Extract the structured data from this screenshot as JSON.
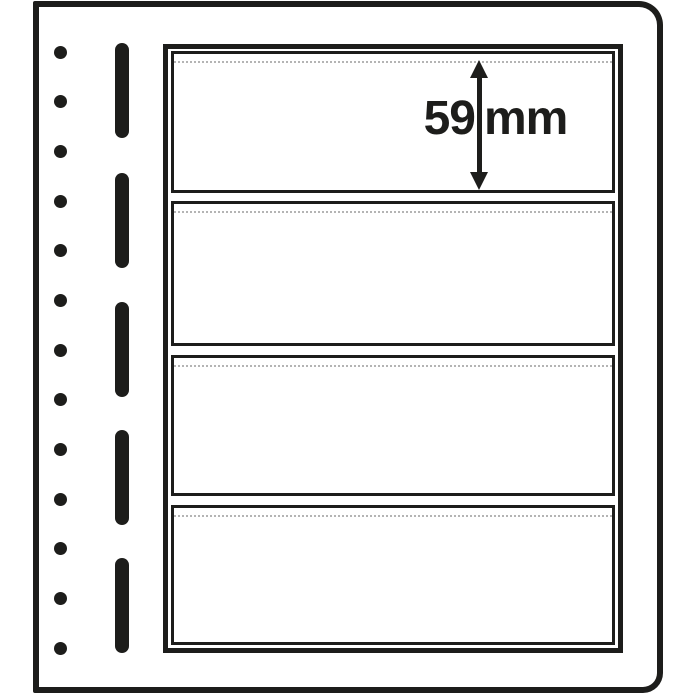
{
  "annotation": {
    "value": "59",
    "unit": "mm",
    "label": "59 mm",
    "arrow_icon": "vertical-double-arrow-icon"
  },
  "sheet": {
    "type": "blank-stock-sheet",
    "pocket_count": 4,
    "punch_hole_count": 13,
    "binding_slot_count": 5
  },
  "colors": {
    "ink": "#1d1d1b",
    "paper": "#ffffff",
    "foil_edge_dotted": "#b4b4b4"
  }
}
